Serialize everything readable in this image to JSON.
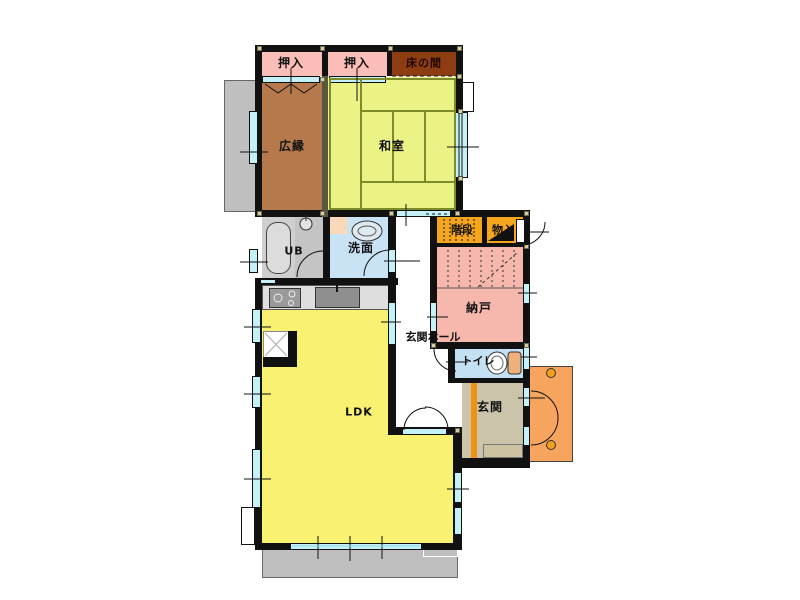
{
  "plan_title": "1F floor plan",
  "rooms": {
    "oshiire_left": {
      "label": "押入"
    },
    "oshiire_right": {
      "label": "押入"
    },
    "tokonoma": {
      "label": "床の間"
    },
    "hiroen": {
      "label": "広縁"
    },
    "washitsu": {
      "label": "和室"
    },
    "unit_bath": {
      "label": "UB"
    },
    "senmen": {
      "label": "洗面"
    },
    "kaidan": {
      "label": "階段"
    },
    "monoire": {
      "label": "物入"
    },
    "nando": {
      "label": "納戸"
    },
    "genkan_hall": {
      "label": "玄関ホール"
    },
    "toilet": {
      "label": "トイレ"
    },
    "ldk": {
      "label": "LDK"
    },
    "genkan": {
      "label": "玄関"
    }
  },
  "palette": {
    "wall": "#111111",
    "window_glass": "#c4f1f8",
    "closet_pink": "#fbbdb8",
    "tokonoma_brown": "#8e3d12",
    "hiroen_brown": "#b5794b",
    "tatami_green": "#ecf386",
    "tatami_line": "#7c8a28",
    "bath_gray": "#cfcfcf",
    "senmen_blue": "#c9e3f5",
    "stairs_orange": "#f6a61d",
    "nando_pink": "#f6b7ad",
    "toilet_blue": "#c4e1f3",
    "ldk_yellow": "#f8f172",
    "genkan_tan": "#cbc4ab",
    "genkan_step_orange": "#ef9212",
    "porch_orange": "#f7a55e",
    "terrace_gray": "#bfbfbf",
    "pillar_beige": "#d9cfa2"
  }
}
